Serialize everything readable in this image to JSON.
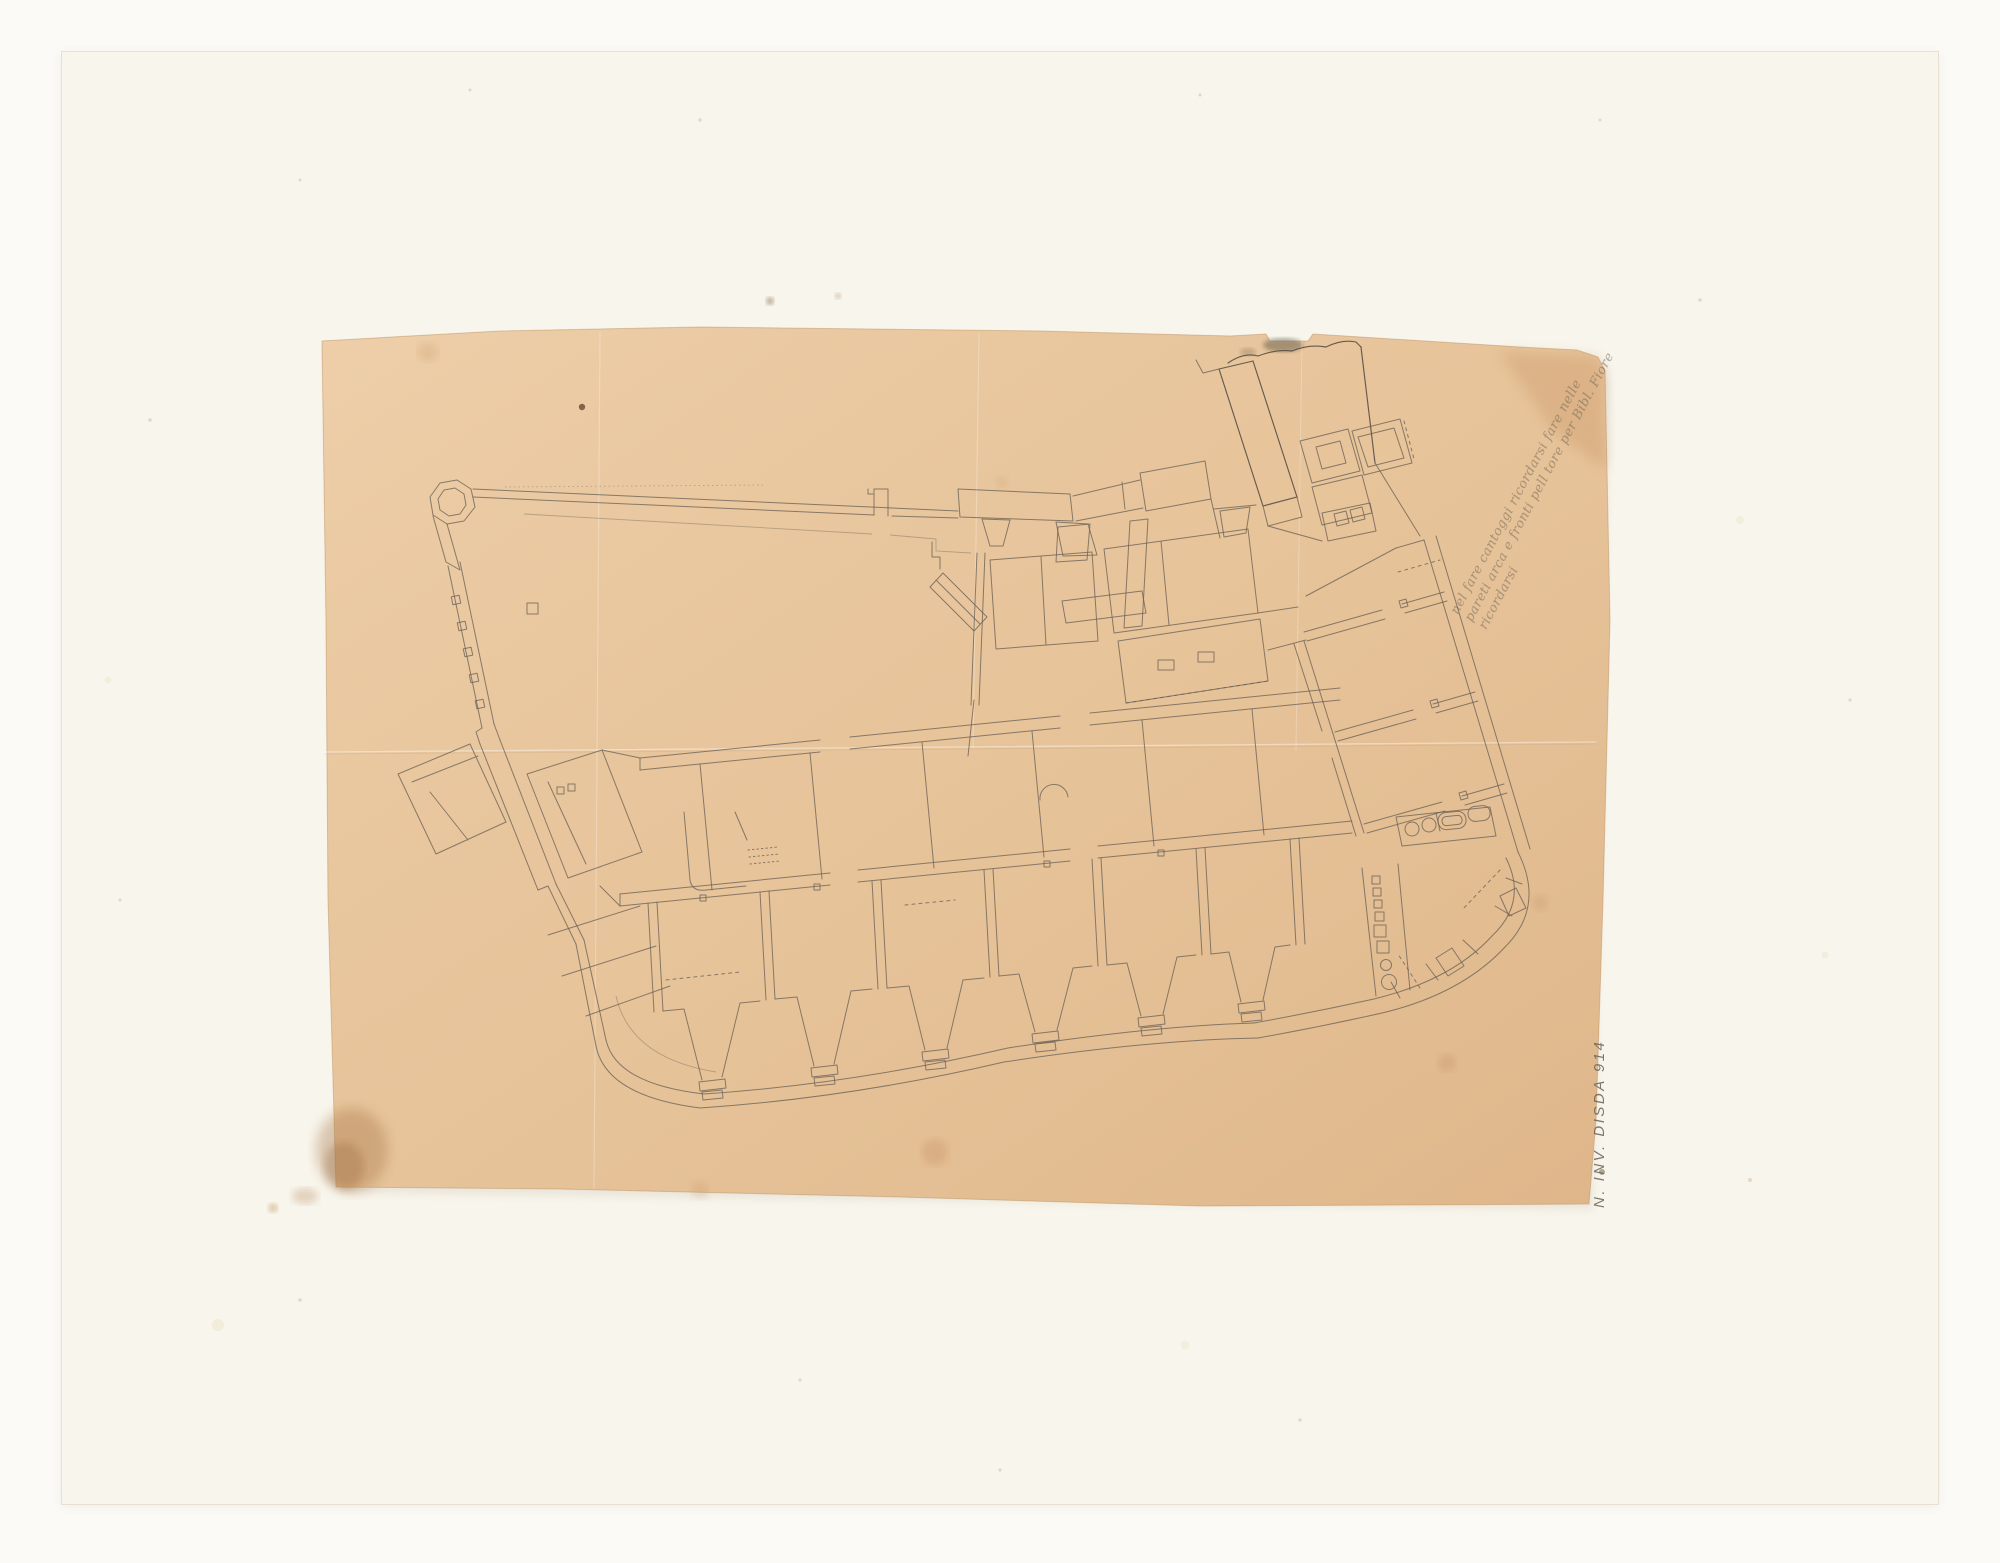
{
  "annotation_note": {
    "line1": "nel fare cantoggi ricordarsi fare nelle",
    "line2": "pareti arca e fronti pell tore per Bibl. Fiore",
    "line3": "ricordarsi"
  },
  "inventory_mark": {
    "text": "N. INV. DISDA 914"
  },
  "colors": {
    "page_background": "#fbfaf6",
    "board": "#f8f5ec",
    "paper": "#e8c59c",
    "pencil": "#6a6256",
    "pencil_dark": "#4e4840",
    "stain_brown": "#a87848"
  }
}
